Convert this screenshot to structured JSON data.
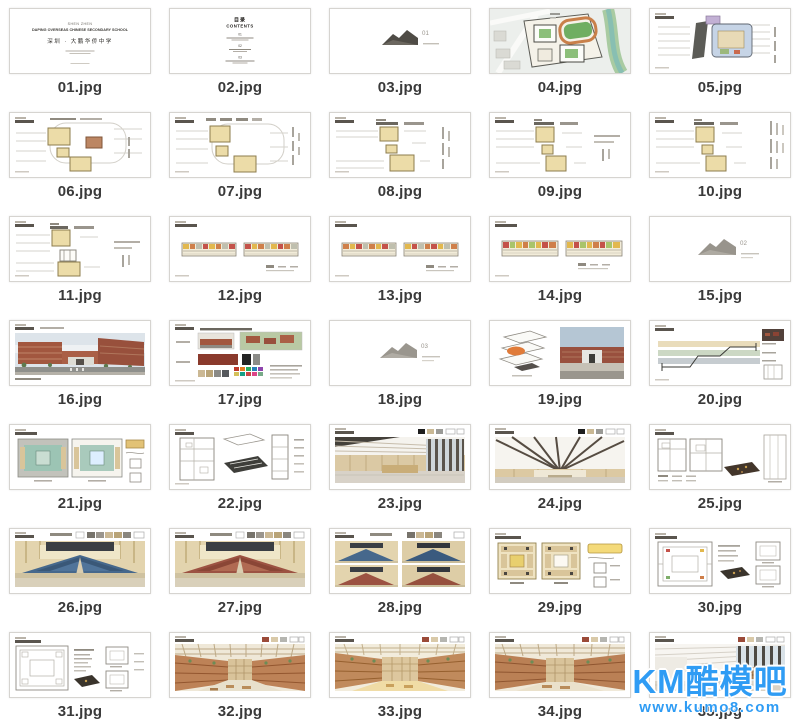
{
  "watermark": {
    "brand": "KM酷模吧",
    "url": "www.kumo8.com",
    "color": "#2f9cf4"
  },
  "cover": {
    "line1": "SHEN ZHEN",
    "line2": "DAPING OVERSEAS CHINESE SECONDARY SCHOOL",
    "line3": "深圳 · 大鹏华侨中学"
  },
  "contents": {
    "cn": "目录",
    "en": "CONTENTS",
    "item1": "01",
    "item2": "02",
    "item3": "03"
  },
  "dividers": {
    "d1": "01",
    "d2": "02",
    "d3": "03"
  },
  "files": [
    {
      "name": "01.jpg",
      "desc": "cover slide"
    },
    {
      "name": "02.jpg",
      "desc": "contents slide"
    },
    {
      "name": "03.jpg",
      "desc": "section divider 01"
    },
    {
      "name": "04.jpg",
      "desc": "site master plan"
    },
    {
      "name": "05.jpg",
      "desc": "colored zoning plan"
    },
    {
      "name": "06.jpg",
      "desc": "floor plan"
    },
    {
      "name": "07.jpg",
      "desc": "floor plan"
    },
    {
      "name": "08.jpg",
      "desc": "floor plan"
    },
    {
      "name": "09.jpg",
      "desc": "floor plan"
    },
    {
      "name": "10.jpg",
      "desc": "floor plan"
    },
    {
      "name": "11.jpg",
      "desc": "floor plan"
    },
    {
      "name": "12.jpg",
      "desc": "classroom strip plans"
    },
    {
      "name": "13.jpg",
      "desc": "classroom strip plans"
    },
    {
      "name": "14.jpg",
      "desc": "classroom strip plans"
    },
    {
      "name": "15.jpg",
      "desc": "section divider 02"
    },
    {
      "name": "16.jpg",
      "desc": "exterior rendering"
    },
    {
      "name": "17.jpg",
      "desc": "facade materials board"
    },
    {
      "name": "18.jpg",
      "desc": "section divider 03"
    },
    {
      "name": "19.jpg",
      "desc": "axon diagram + entrance render"
    },
    {
      "name": "20.jpg",
      "desc": "building section"
    },
    {
      "name": "21.jpg",
      "desc": "colored plans"
    },
    {
      "name": "22.jpg",
      "desc": "line plans + dark axon"
    },
    {
      "name": "23.jpg",
      "desc": "lobby interior render"
    },
    {
      "name": "24.jpg",
      "desc": "hall ceiling render"
    },
    {
      "name": "25.jpg",
      "desc": "plans + axon"
    },
    {
      "name": "26.jpg",
      "desc": "auditorium render blue seats"
    },
    {
      "name": "27.jpg",
      "desc": "auditorium render red seats"
    },
    {
      "name": "28.jpg",
      "desc": "auditorium four views"
    },
    {
      "name": "29.jpg",
      "desc": "colored square plans"
    },
    {
      "name": "30.jpg",
      "desc": "square plan + axon"
    },
    {
      "name": "31.jpg",
      "desc": "square plan + details"
    },
    {
      "name": "32.jpg",
      "desc": "atrium interior render"
    },
    {
      "name": "33.jpg",
      "desc": "atrium interior render"
    },
    {
      "name": "34.jpg",
      "desc": "atrium interior render"
    },
    {
      "name": "35.jpg",
      "desc": "reading room interior render"
    }
  ]
}
